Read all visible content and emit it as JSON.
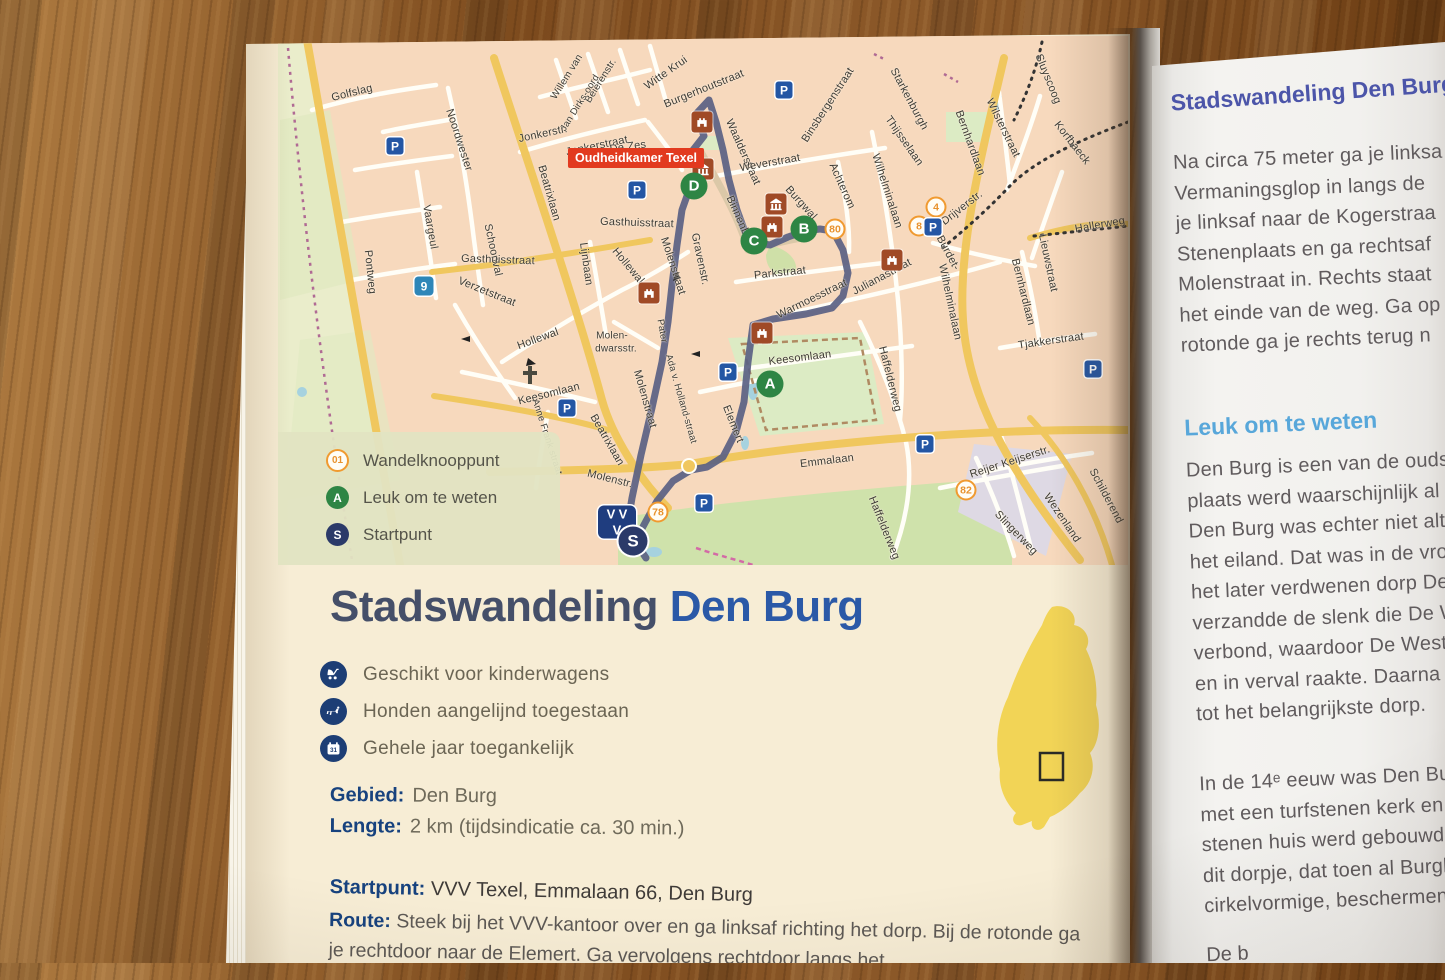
{
  "colors": {
    "green": "#2e8544",
    "red": "#e23a1f",
    "route": "#5a6183",
    "titleblue": "#2b59a7",
    "headblue": "#4c55a9",
    "lightblue": "#58a7da",
    "navy": "#1d3e75",
    "orange": "#f09a30",
    "island": "#f2d456"
  },
  "map": {
    "parking_glyph": "P",
    "poi_label": {
      "text": "Oudheidkamer Texel",
      "x": 636,
      "y": 158
    },
    "legend": [
      {
        "icon": "01",
        "label": "Wandelknooppunt",
        "type": "junction"
      },
      {
        "icon": "A",
        "label": "Leuk om te weten",
        "type": "poi"
      },
      {
        "icon": "S",
        "label": "Startpunt",
        "type": "start"
      }
    ],
    "streets": [
      {
        "t": "Golfslag",
        "x": 352,
        "y": 93,
        "r": -14
      },
      {
        "t": "Noordwester",
        "x": 459,
        "y": 140,
        "r": 72
      },
      {
        "t": "Vaargeul",
        "x": 430,
        "y": 227,
        "r": 80
      },
      {
        "t": "Schoonval",
        "x": 493,
        "y": 250,
        "r": 78
      },
      {
        "t": "Gasthuisstraat",
        "x": 498,
        "y": 260,
        "r": 2
      },
      {
        "t": "Verzetstraat",
        "x": 487,
        "y": 292,
        "r": 22
      },
      {
        "t": "Pontweg",
        "x": 370,
        "y": 272,
        "r": 84
      },
      {
        "t": "Beatrixlaan",
        "x": 549,
        "y": 193,
        "r": 74
      },
      {
        "t": "Beatrixlaan",
        "x": 607,
        "y": 440,
        "r": 60
      },
      {
        "t": "Jonkerstr.",
        "x": 543,
        "y": 134,
        "r": -12
      },
      {
        "t": "Jonkerstraat",
        "x": 597,
        "y": 146,
        "r": -12
      },
      {
        "t": "De Zes",
        "x": 628,
        "y": 147,
        "r": -8
      },
      {
        "t": "Willem van",
        "x": 567,
        "y": 77,
        "r": -58,
        "s": 10
      },
      {
        "t": "Beierenstr.",
        "x": 601,
        "y": 81,
        "r": -58,
        "s": 10
      },
      {
        "t": "Jan Dirks-oord",
        "x": 580,
        "y": 103,
        "r": -58,
        "s": 9.5
      },
      {
        "t": "Witte Krui",
        "x": 666,
        "y": 73,
        "r": -35
      },
      {
        "t": "Burgerhoutstraat",
        "x": 704,
        "y": 89,
        "r": -22
      },
      {
        "t": "Waalderstraat",
        "x": 743,
        "y": 152,
        "r": 66
      },
      {
        "t": "Weverstraat",
        "x": 770,
        "y": 163,
        "r": -10
      },
      {
        "t": "Binsbergenstraat",
        "x": 828,
        "y": 105,
        "r": -57
      },
      {
        "t": "Starkenburgh",
        "x": 909,
        "y": 99,
        "r": 62
      },
      {
        "t": "Thijsselaan",
        "x": 904,
        "y": 141,
        "r": 55
      },
      {
        "t": "Sluyscoog",
        "x": 1048,
        "y": 79,
        "r": 68
      },
      {
        "t": "Wilsterstraat",
        "x": 1003,
        "y": 128,
        "r": 64
      },
      {
        "t": "Bernhardlaan",
        "x": 970,
        "y": 143,
        "r": 70
      },
      {
        "t": "Bernhardlaan",
        "x": 1023,
        "y": 292,
        "r": 76
      },
      {
        "t": "Korfbaeck",
        "x": 1072,
        "y": 143,
        "r": 52
      },
      {
        "t": "Drijverstr.",
        "x": 962,
        "y": 208,
        "r": -38
      },
      {
        "t": "Hallerweg",
        "x": 1100,
        "y": 225,
        "r": -10
      },
      {
        "t": "Wilhelminalaan",
        "x": 887,
        "y": 191,
        "r": 72
      },
      {
        "t": "Wilhelminalaan",
        "x": 950,
        "y": 302,
        "r": 78
      },
      {
        "t": "Achterom",
        "x": 842,
        "y": 186,
        "r": 66
      },
      {
        "t": "Burgwal",
        "x": 801,
        "y": 203,
        "r": 48
      },
      {
        "t": "Binnenburg",
        "x": 741,
        "y": 223,
        "r": 66
      },
      {
        "t": "Parkstraat",
        "x": 780,
        "y": 273,
        "r": -6
      },
      {
        "t": "Warmoesstraat",
        "x": 812,
        "y": 299,
        "r": -26
      },
      {
        "t": "Julianastraat",
        "x": 882,
        "y": 277,
        "r": -28
      },
      {
        "t": "Gravenstr.",
        "x": 700,
        "y": 259,
        "r": 78
      },
      {
        "t": "Molenstraat",
        "x": 673,
        "y": 266,
        "r": 72
      },
      {
        "t": "Molenstraat",
        "x": 645,
        "y": 399,
        "r": 74
      },
      {
        "t": "Molenstr.",
        "x": 610,
        "y": 479,
        "r": 14
      },
      {
        "t": "Hollewal",
        "x": 538,
        "y": 339,
        "r": -20
      },
      {
        "t": "Hollewal",
        "x": 628,
        "y": 266,
        "r": 50
      },
      {
        "t": "Lijnbaan",
        "x": 586,
        "y": 264,
        "r": 82
      },
      {
        "t": "Molen-",
        "x": 612,
        "y": 336,
        "r": 0,
        "s": 10
      },
      {
        "t": "dwarsstr.",
        "x": 616,
        "y": 349,
        "r": 0,
        "s": 10
      },
      {
        "t": "Pater",
        "x": 662,
        "y": 331,
        "r": 80,
        "s": 9.5
      },
      {
        "t": "Ada v. Holland-straat",
        "x": 681,
        "y": 399,
        "r": 74,
        "s": 9.5
      },
      {
        "t": "Keesomlaan",
        "x": 800,
        "y": 358,
        "r": -7
      },
      {
        "t": "Keesomlaan",
        "x": 549,
        "y": 394,
        "r": -14
      },
      {
        "t": "Anne Frank straat",
        "x": 547,
        "y": 437,
        "r": 72,
        "s": 9.5
      },
      {
        "t": "Elemert",
        "x": 733,
        "y": 424,
        "r": 68
      },
      {
        "t": "Emmalaan",
        "x": 827,
        "y": 461,
        "r": -7
      },
      {
        "t": "Haffelderweg",
        "x": 890,
        "y": 379,
        "r": 76
      },
      {
        "t": "Haffelderweg",
        "x": 884,
        "y": 528,
        "r": 68
      },
      {
        "t": "Reijer Keijserstr.",
        "x": 1010,
        "y": 462,
        "r": -18
      },
      {
        "t": "Wezenland",
        "x": 1062,
        "y": 518,
        "r": 56
      },
      {
        "t": "Slingerweg",
        "x": 1016,
        "y": 533,
        "r": 46
      },
      {
        "t": "Schilderend",
        "x": 1106,
        "y": 496,
        "r": 62
      },
      {
        "t": "Burdet-",
        "x": 948,
        "y": 253,
        "r": 62
      },
      {
        "t": "Lieuwstraat",
        "x": 1048,
        "y": 263,
        "r": 78
      },
      {
        "t": "Tjakkerstraat",
        "x": 1051,
        "y": 341,
        "r": -8
      },
      {
        "t": "Gasthuisstraat",
        "x": 637,
        "y": 223,
        "r": 2
      }
    ],
    "junctions": [
      {
        "n": "80",
        "x": 835,
        "y": 229
      },
      {
        "n": "4",
        "x": 936,
        "y": 207
      },
      {
        "n": "8",
        "x": 919,
        "y": 226
      },
      {
        "n": "82",
        "x": 966,
        "y": 490
      },
      {
        "n": "78",
        "x": 658,
        "y": 512
      }
    ],
    "route_markers": [
      {
        "n": "D",
        "x": 694,
        "y": 186
      },
      {
        "n": "C",
        "x": 754,
        "y": 241
      },
      {
        "n": "B",
        "x": 804,
        "y": 229
      },
      {
        "n": "A",
        "x": 770,
        "y": 384
      }
    ],
    "start_marker": {
      "n": "S",
      "x": 633,
      "y": 541
    },
    "vvv_marker": {
      "letters": "VVV",
      "x": 617,
      "y": 522
    },
    "cycle_marker": {
      "n": "9",
      "x": 424,
      "y": 286
    },
    "parking": [
      {
        "x": 395,
        "y": 146
      },
      {
        "x": 784,
        "y": 90
      },
      {
        "x": 637,
        "y": 190
      },
      {
        "x": 567,
        "y": 408
      },
      {
        "x": 728,
        "y": 372
      },
      {
        "x": 925,
        "y": 444
      },
      {
        "x": 1093,
        "y": 369
      },
      {
        "x": 704,
        "y": 503
      },
      {
        "x": 933,
        "y": 227
      }
    ],
    "museums": [
      {
        "x": 702,
        "y": 122,
        "k": "castle"
      },
      {
        "x": 703,
        "y": 169,
        "k": "columns"
      },
      {
        "x": 776,
        "y": 204,
        "k": "columns"
      },
      {
        "x": 772,
        "y": 227,
        "k": "castle"
      },
      {
        "x": 892,
        "y": 260,
        "k": "castle"
      },
      {
        "x": 649,
        "y": 293,
        "k": "castle"
      },
      {
        "x": 762,
        "y": 333,
        "k": "castle"
      }
    ]
  },
  "left_page": {
    "title": {
      "part1": "Stadswandeling",
      "part2": "Den Burg"
    },
    "features": [
      {
        "icon": "stroller-icon",
        "label": "Geschikt voor kinderwagens"
      },
      {
        "icon": "dog-icon",
        "label": "Honden aangelijnd toegestaan"
      },
      {
        "icon": "calendar-icon",
        "label": "Gehele jaar toegankelijk",
        "badge": "31"
      }
    ],
    "details": [
      {
        "label": "Gebied:",
        "value": "Den Burg"
      },
      {
        "label": "Lengte:",
        "value": "2 km (tijdsindicatie ca. 30 min.)"
      }
    ],
    "start": {
      "label": "Startpunt:",
      "value": "VVV Texel, Emmalaan 66, Den Burg"
    },
    "route": {
      "label": "Route:",
      "value": "Steek bij het VVV-kantoor over en ga linksaf richting het dorp. Bij de rotonde ga je rechtdoor naar de Elemert. Ga vervolgens rechtdoor langs het"
    }
  },
  "right_page": {
    "heading": "Stadswandeling Den Burg",
    "para1_lines": [
      "Na circa 75 meter ga je linksa",
      "Vermaningsglop in langs de",
      "je linksaf naar de Kogerstraa",
      "Stenenplaats en ga rechtsaf",
      "Molenstraat in. Rechts staat",
      "het einde van de weg. Ga op",
      "rotonde ga je rechts terug n"
    ],
    "subheading": "Leuk om te weten",
    "para2_lines": [
      "Den Burg is een van de ouds",
      "plaats werd waarschijnlijk al",
      "Den Burg was echter niet alt",
      "het eiland. Dat was in de vro",
      "het later verdwenen dorp De",
      "verzandde de slenk die De W",
      "verbond, waardoor De West",
      "en in verval raakte. Daarna",
      "tot het belangrijkste dorp."
    ],
    "para3_lines": [
      "In de 14ᵉ eeuw was Den Burg",
      "met een turfstenen kerk en h",
      "stenen huis werd gebouwd i",
      "dit dorpje, dat toen al Burgh",
      "cirkelvormige, beschermend"
    ],
    "para4_partial": "De b"
  }
}
